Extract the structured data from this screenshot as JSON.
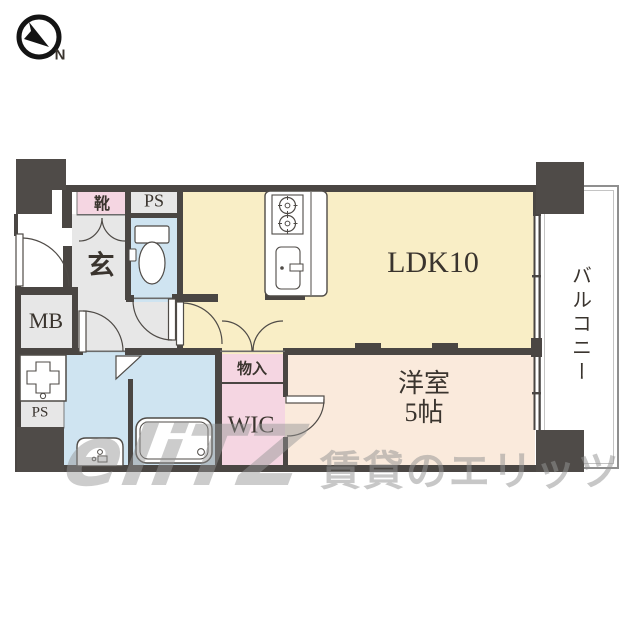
{
  "compass": {
    "label": "N"
  },
  "rooms": {
    "ldk": {
      "label": "LDK10"
    },
    "western": {
      "label_line1": "洋室",
      "label_line2": "5帖"
    },
    "balcony": {
      "label": "バルコニー"
    },
    "wic": {
      "label": "WIC"
    },
    "storage": {
      "label": "物入"
    },
    "entrance": {
      "label": "玄"
    },
    "shoes": {
      "label": "靴"
    },
    "meter_box": {
      "label": "MB"
    },
    "pipe_space_top": {
      "label": "PS"
    },
    "pipe_space_bottom": {
      "label": "PS"
    }
  },
  "watermark": {
    "logo": "eliTZ",
    "text": "賃貸のエリッツ"
  },
  "colors": {
    "wall": "#4a4643",
    "pillar": "#4f4b48",
    "room_gray": "#e7e7e7",
    "room_blue": "#cfe4f1",
    "room_yellow": "#f9eec6",
    "room_peach": "#faeadc",
    "room_pink": "#f5d6e2",
    "label_text": "#3a342e",
    "balcony_border": "#8f8f8f",
    "watermark_gray": "#949494"
  }
}
